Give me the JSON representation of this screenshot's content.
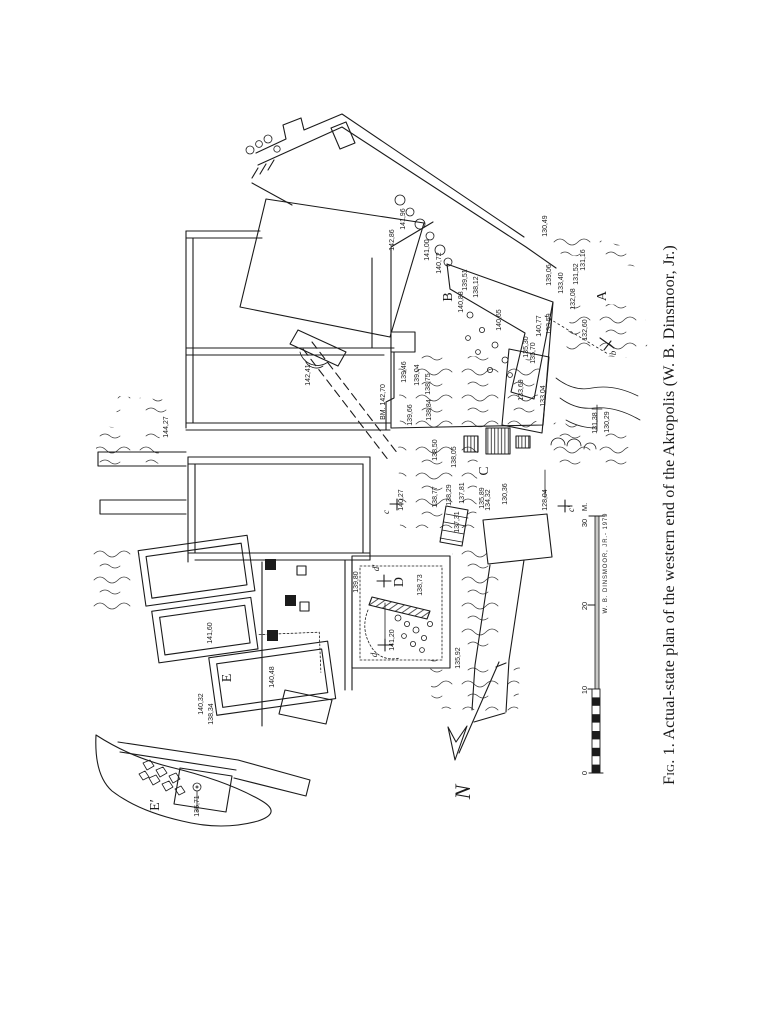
{
  "page": {
    "background": "#ffffff",
    "ink": "#1b1b1b"
  },
  "caption": {
    "fig_label": "Fig. 1.",
    "text": " Actual-state plan of the western end of the Akropolis (W. B. Dinsmoor, Jr.)"
  },
  "north": {
    "label": "N"
  },
  "scale_bar": {
    "unit_label": "M.",
    "unit_x": 587,
    "unit_y": 507,
    "signature": "W. B. DINSMOOR, JR.- 1979",
    "ticks": [
      {
        "t": "0",
        "x": 587,
        "y": 773
      },
      {
        "t": "10",
        "x": 587,
        "y": 690
      },
      {
        "t": "20",
        "x": 587,
        "y": 606
      },
      {
        "t": "30",
        "x": 587,
        "y": 523
      }
    ]
  },
  "plan": {
    "area_letters": [
      {
        "t": "A",
        "x": 606,
        "y": 296
      },
      {
        "t": "B",
        "x": 452,
        "y": 297
      },
      {
        "t": "C",
        "x": 488,
        "y": 471
      },
      {
        "t": "D",
        "x": 403,
        "y": 582
      },
      {
        "t": "E",
        "x": 231,
        "y": 678
      },
      {
        "t": "E′",
        "x": 159,
        "y": 805
      }
    ],
    "section_markers": [
      {
        "t": "b",
        "x": 616,
        "y": 353
      },
      {
        "t": "c",
        "x": 389,
        "y": 512
      },
      {
        "t": "c′",
        "x": 574,
        "y": 509
      },
      {
        "t": "d′",
        "x": 379,
        "y": 568
      },
      {
        "t": "d",
        "x": 377,
        "y": 655
      }
    ],
    "elevations": [
      {
        "t": "142,86",
        "x": 394,
        "y": 240
      },
      {
        "t": "141,96",
        "x": 405,
        "y": 219
      },
      {
        "t": "141,00",
        "x": 429,
        "y": 250
      },
      {
        "t": "140,72",
        "x": 441,
        "y": 263
      },
      {
        "t": "139,51",
        "x": 467,
        "y": 280
      },
      {
        "t": "138,12",
        "x": 478,
        "y": 287
      },
      {
        "t": "130,49",
        "x": 547,
        "y": 226
      },
      {
        "t": "139,06",
        "x": 551,
        "y": 275
      },
      {
        "t": "133,40",
        "x": 563,
        "y": 283
      },
      {
        "t": "131,52",
        "x": 578,
        "y": 274
      },
      {
        "t": "131,16",
        "x": 585,
        "y": 260
      },
      {
        "t": "132,08",
        "x": 575,
        "y": 299
      },
      {
        "t": "132,60",
        "x": 587,
        "y": 330
      },
      {
        "t": "140,88",
        "x": 463,
        "y": 302
      },
      {
        "t": "140,65",
        "x": 501,
        "y": 320
      },
      {
        "t": "140,77",
        "x": 541,
        "y": 326
      },
      {
        "t": "133,59",
        "x": 551,
        "y": 324
      },
      {
        "t": "135,30",
        "x": 528,
        "y": 347
      },
      {
        "t": "135,70",
        "x": 535,
        "y": 353
      },
      {
        "t": "133,69",
        "x": 523,
        "y": 390
      },
      {
        "t": "133,04",
        "x": 545,
        "y": 396
      },
      {
        "t": "131,38",
        "x": 597,
        "y": 423
      },
      {
        "t": "130,29",
        "x": 609,
        "y": 422
      },
      {
        "t": "BM. 142,70",
        "x": 385,
        "y": 402
      },
      {
        "t": "142,41",
        "x": 310,
        "y": 375
      },
      {
        "t": "139,46",
        "x": 406,
        "y": 372
      },
      {
        "t": "139,04",
        "x": 419,
        "y": 375
      },
      {
        "t": "138,75",
        "x": 430,
        "y": 384
      },
      {
        "t": "139,66",
        "x": 412,
        "y": 415
      },
      {
        "t": "138,84",
        "x": 431,
        "y": 410
      },
      {
        "t": "144,27",
        "x": 168,
        "y": 427
      },
      {
        "t": "138,50",
        "x": 437,
        "y": 450
      },
      {
        "t": "138,05",
        "x": 456,
        "y": 457
      },
      {
        "t": "140,27",
        "x": 403,
        "y": 500
      },
      {
        "t": "138,77",
        "x": 437,
        "y": 497
      },
      {
        "t": "138,29",
        "x": 451,
        "y": 495
      },
      {
        "t": "137,81",
        "x": 464,
        "y": 493
      },
      {
        "t": "137,31",
        "x": 459,
        "y": 522
      },
      {
        "t": "135,89",
        "x": 484,
        "y": 498
      },
      {
        "t": "134,32",
        "x": 490,
        "y": 500
      },
      {
        "t": "130,36",
        "x": 507,
        "y": 494
      },
      {
        "t": "128,04",
        "x": 547,
        "y": 500
      },
      {
        "t": "139,80",
        "x": 358,
        "y": 582
      },
      {
        "t": "138,73",
        "x": 422,
        "y": 585
      },
      {
        "t": "141,20",
        "x": 394,
        "y": 640
      },
      {
        "t": "135,92",
        "x": 460,
        "y": 658
      },
      {
        "t": "141,60",
        "x": 212,
        "y": 633
      },
      {
        "t": "140,48",
        "x": 274,
        "y": 677
      },
      {
        "t": "140,32",
        "x": 203,
        "y": 704
      },
      {
        "t": "138,34",
        "x": 213,
        "y": 714
      },
      {
        "t": "135,71",
        "x": 199,
        "y": 806
      }
    ]
  }
}
